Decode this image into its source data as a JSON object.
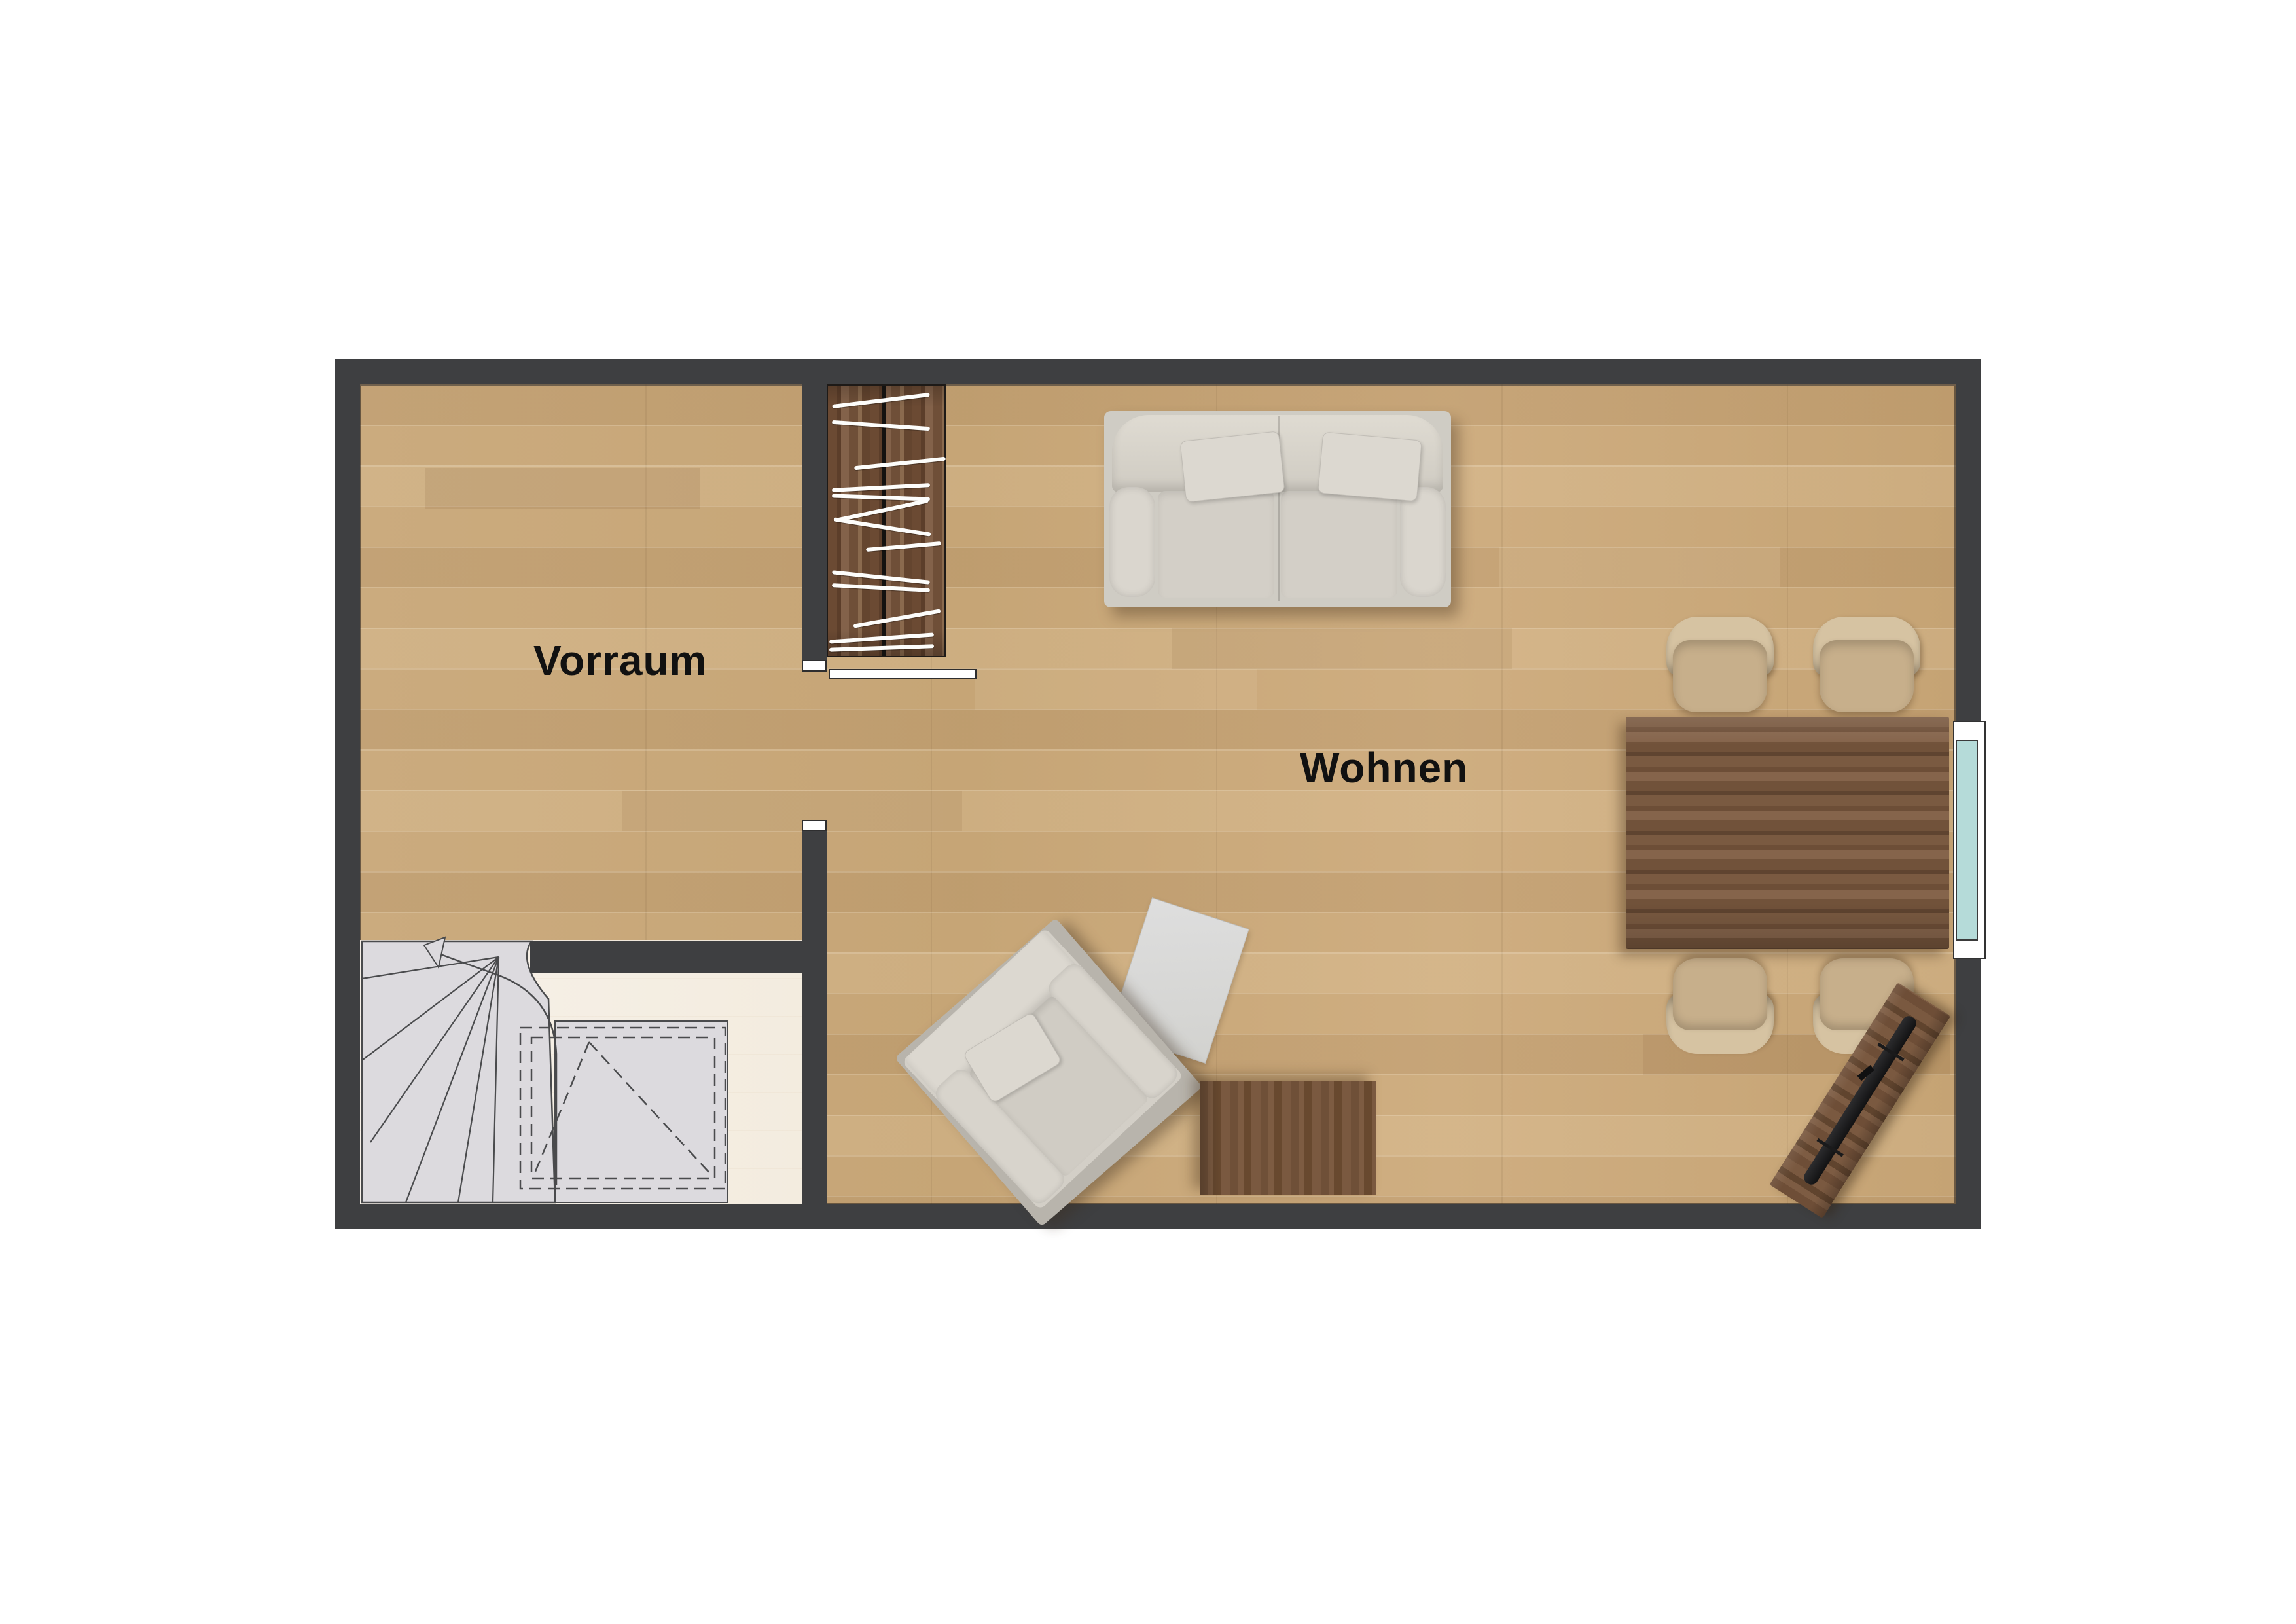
{
  "page": {
    "type": "floor-plan",
    "background": "#ffffff",
    "description": "Top-down rendered floor plan of an entrance hall and living room"
  },
  "rooms": [
    {
      "id": "vorraum",
      "label": "Vorraum"
    },
    {
      "id": "wohnen",
      "label": "Wohnen"
    }
  ],
  "palette": {
    "wall": "#3e3f41",
    "wood_floor": "#c9a87a",
    "stair_floor": "#f6f0e7",
    "stair_step": "#dcdade",
    "walnut_furniture": "#75543c",
    "sofa_fabric": "#d3cfc7",
    "chair_tan": "#cdb795",
    "window_glass": "#b5dbd9",
    "plan_outline": "#4a4b4d",
    "label_color": "#111111"
  },
  "furniture": [
    {
      "name": "wardrobe-closet",
      "room": "vorraum",
      "style": "walnut with clothes hangers"
    },
    {
      "name": "winder-staircase",
      "room": "vorraum",
      "direction": "up",
      "marking": "dashed opening above"
    },
    {
      "name": "two-seat-sofa",
      "room": "wohnen"
    },
    {
      "name": "armchair",
      "room": "wohnen",
      "rotation": "diagonal"
    },
    {
      "name": "rug",
      "room": "wohnen"
    },
    {
      "name": "coffee-table",
      "room": "wohnen",
      "style": "walnut"
    },
    {
      "name": "dining-table",
      "room": "wohnen",
      "style": "walnut",
      "chairs": 4
    },
    {
      "name": "tv-sideboard",
      "room": "wohnen",
      "rotation": "diagonal"
    }
  ],
  "openings": {
    "window_right_wall": 1,
    "door_leaf_open": 1,
    "wall_end_caps": 2
  }
}
